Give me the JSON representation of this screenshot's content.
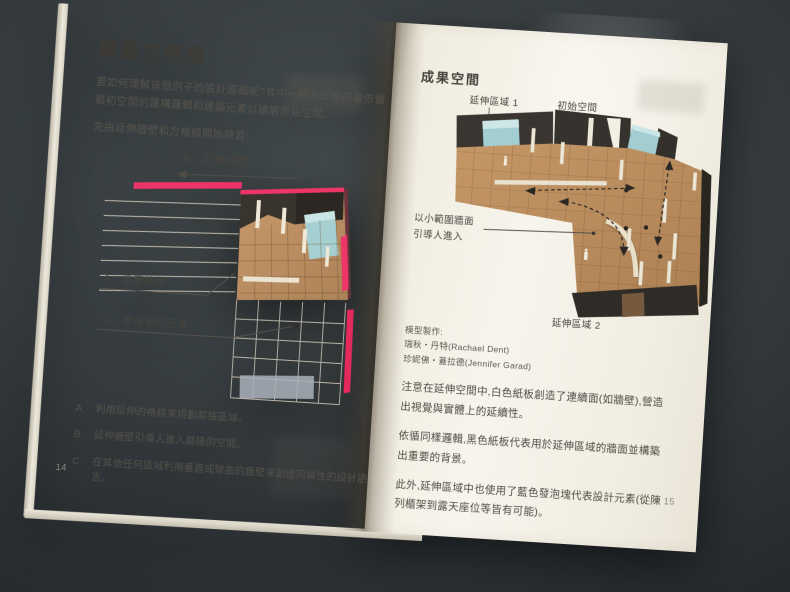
{
  "colors": {
    "accent_pink": "#ee3567",
    "cardboard": "#c0945f",
    "wall_dark": "#38332d",
    "foam_blue": "#a5cfd2",
    "page_cream": "#f2eee3",
    "table_dark": "#2c3134"
  },
  "page_left": {
    "page_number": "14",
    "title": "擴展方格線",
    "intro": "要如何理解這個例子的設計邏輯呢?其中一種方式是試著依循最初空間的建構邏輯和建築元素以擴展原始空間。",
    "practice_line": "先由延伸牆壁和方格線開始練習:",
    "diagram": {
      "label_b": "B . 延伸牆壁",
      "label_a": "A . 延展格線",
      "label_c": "C . 增設相同元素"
    },
    "list": [
      {
        "key": "A.",
        "text": "利用延伸的格線來規劃鄰接區域。"
      },
      {
        "key": "B.",
        "text": "延伸牆壁引導人進入鄰接的空間。"
      },
      {
        "key": "C.",
        "text": "在其他任何區域利用垂直或彎曲的牆壁來創造同質性的設計語言。"
      }
    ]
  },
  "page_right": {
    "page_number": "15",
    "title": "成果空間",
    "diagram": {
      "label_area1": "延伸區域 1",
      "label_initial": "初始空間",
      "label_wall_line1": "以小範圍牆面",
      "label_wall_line2": "引導人進入",
      "label_area2": "延伸區域 2"
    },
    "credits": {
      "heading": "模型製作:",
      "names": [
        "瑞秋・丹特(Rachael Dent)",
        "珍妮佛・蓋拉德(Jennifer Garad)"
      ]
    },
    "paragraphs": [
      "注意在延伸空間中,白色紙板創造了連續面(如牆壁),營造出視覺與實體上的延續性。",
      "依循同樣邏輯,黑色紙板代表用於延伸區域的牆面並構築出重要的背景。",
      "此外,延伸區域中也使用了藍色發泡塊代表設計元素(從陳列櫃架到露天座位等皆有可能)。"
    ]
  }
}
